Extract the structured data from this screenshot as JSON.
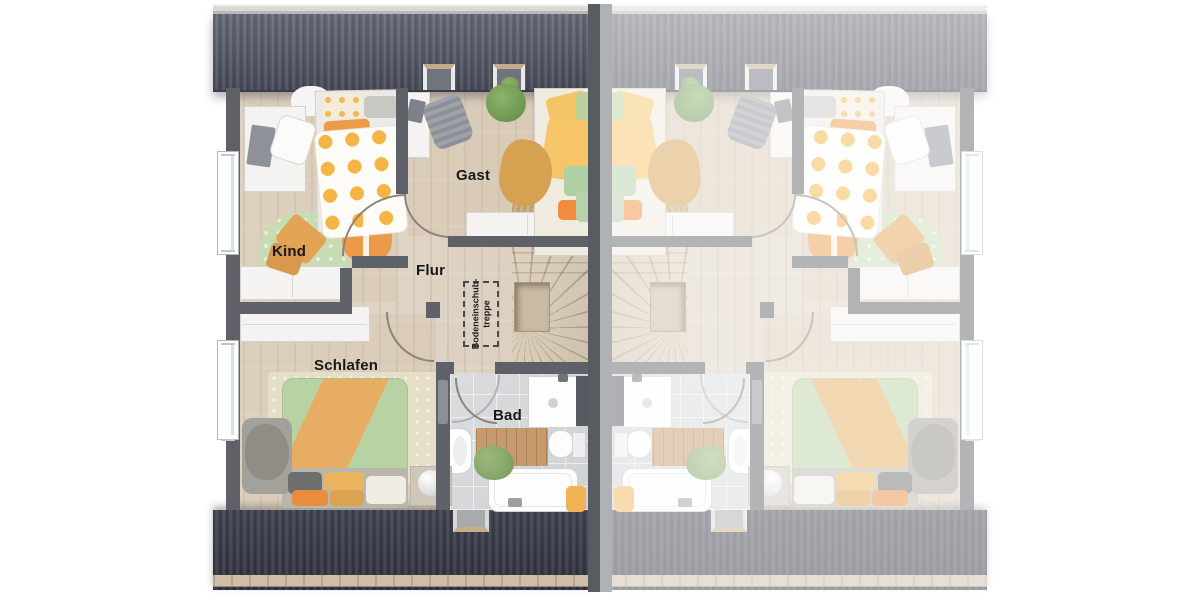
{
  "floorplan": {
    "rooms": [
      {
        "id": "kind",
        "label": "Kind"
      },
      {
        "id": "gast",
        "label": "Gast"
      },
      {
        "id": "flur",
        "label": "Flur"
      },
      {
        "id": "schlafen",
        "label": "Schlafen"
      },
      {
        "id": "bad",
        "label": "Bad"
      }
    ],
    "attic_hatch": {
      "line1": "Bodeneinschub-",
      "line2": "treppe"
    },
    "colors": {
      "roof_top": "#585c6a",
      "roof_bottom": "#3e404e",
      "ridge_cap": "#d9d9d5",
      "eave_wood": "#cfbda6",
      "wall": "#5e6268",
      "floor_wood": "#ddd3c4",
      "stair_wood": "#d7cab7",
      "bath_tile": "#d6d8d9",
      "accent_orange": "#e89a4d",
      "accent_yellow": "#f2c166",
      "accent_green": "#b8d1a6",
      "label_text": "#16181a"
    }
  }
}
